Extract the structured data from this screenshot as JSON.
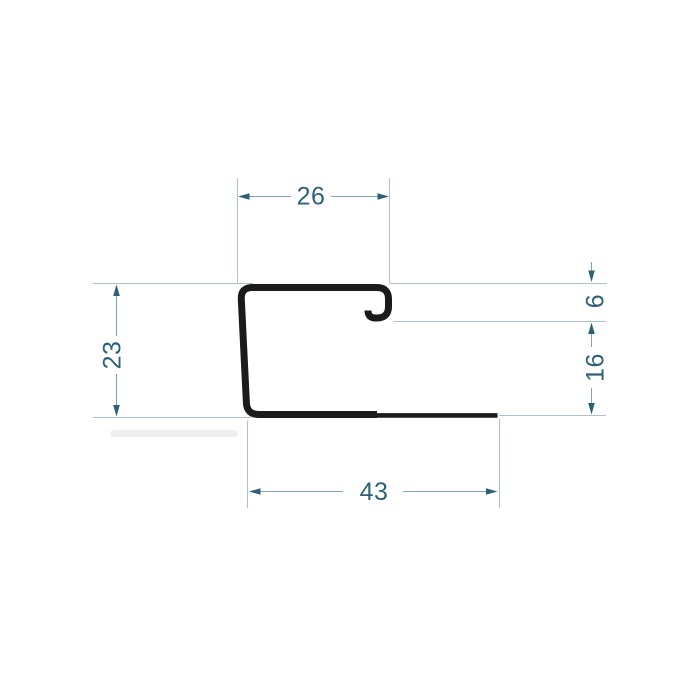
{
  "drawing": {
    "dimensions": {
      "top_width": "26",
      "left_height": "23",
      "hook_offset": "6",
      "right_inner_height": "16",
      "bottom_width": "43"
    }
  },
  "colors": {
    "background": "#ffffff",
    "profile_stroke": "#1b1b1b",
    "extension_line": "#a9c4cf",
    "dimension_line": "#7fa4b5",
    "arrow": "#2e5f78",
    "text": "#2e6078"
  }
}
